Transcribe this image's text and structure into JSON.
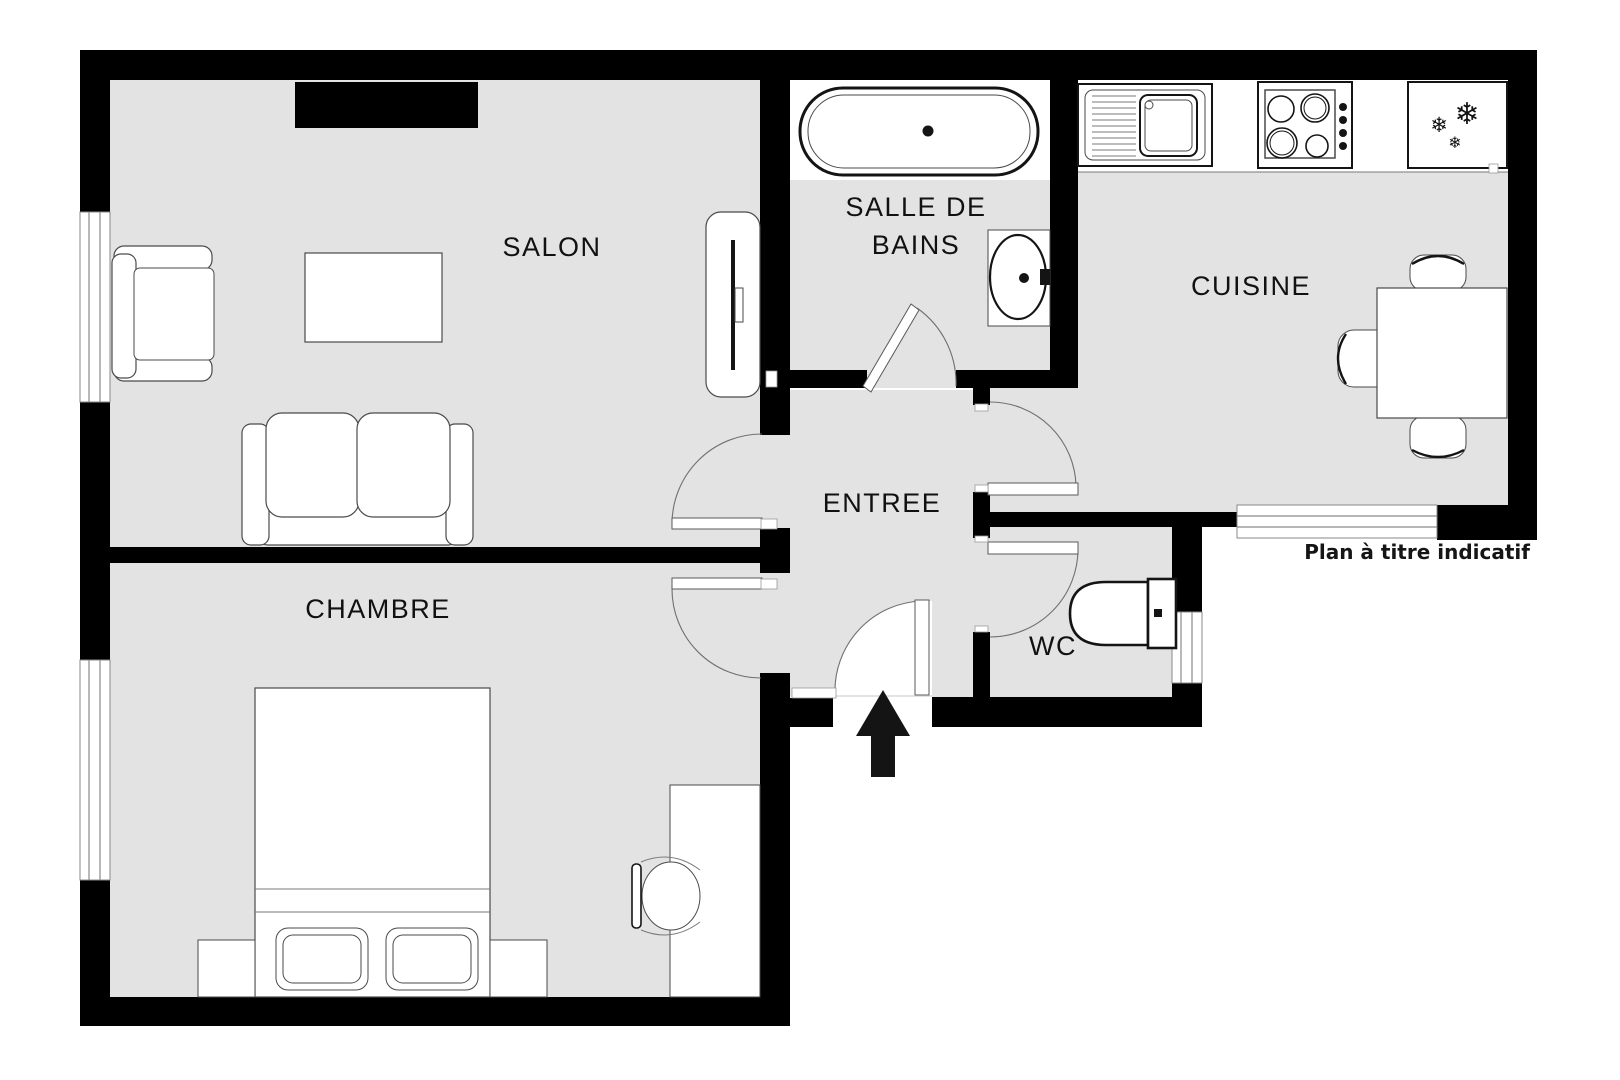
{
  "plan": {
    "rooms": {
      "salon": {
        "label": "SALON"
      },
      "salle_de_bains": {
        "label_line1": "SALLE DE",
        "label_line2": "BAINS"
      },
      "cuisine": {
        "label": "CUISINE"
      },
      "entree": {
        "label": "ENTREE"
      },
      "chambre": {
        "label": "CHAMBRE"
      },
      "wc": {
        "label": "WC"
      }
    },
    "footnote": "Plan à titre indicatif",
    "icons": {
      "snowflake": "❄"
    },
    "colors": {
      "wall": "#000000",
      "floor": "#e3e3e3",
      "background": "#ffffff",
      "outline": "#4a4a4a",
      "text": "#111111"
    }
  }
}
